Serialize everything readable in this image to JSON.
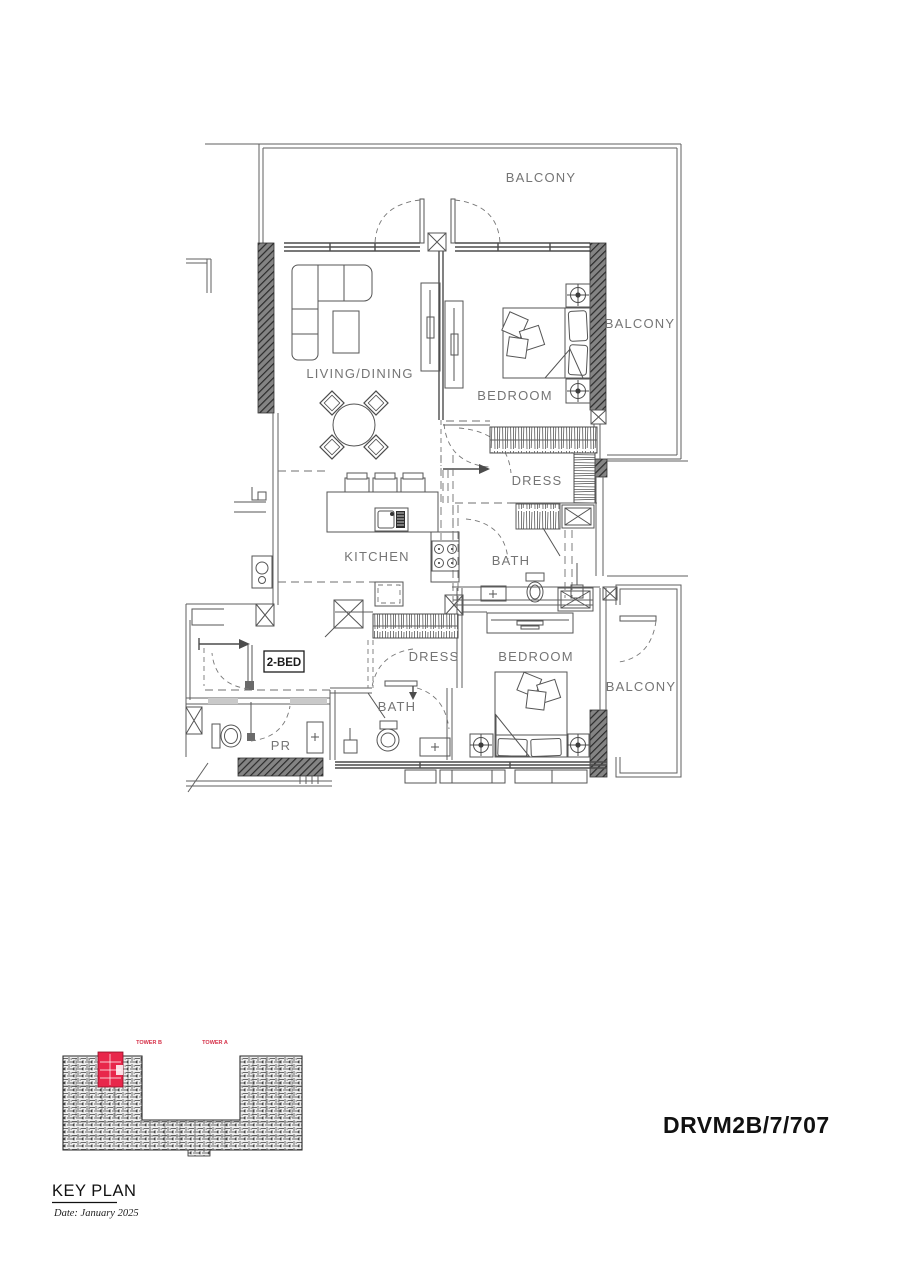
{
  "document": {
    "unit_code": "DRVM2B/7/707",
    "key_plan": {
      "title": "KEY PLAN",
      "date": "Date: January 2025",
      "tower_b": "TOWER B",
      "tower_a": "TOWER A",
      "highlight_color": "#e8274b",
      "tower_label_color": "#d63048"
    },
    "plan": {
      "unit_type": "2-BED",
      "labels": {
        "balcony_top": "BALCONY",
        "balcony_right": "BALCONY",
        "balcony_bottom": "BALCONY",
        "living_dining": "LIVING/DINING",
        "bedroom_top": "BEDROOM",
        "bedroom_bottom": "BEDROOM",
        "dress_top": "DRESS",
        "dress_bottom": "DRESS",
        "kitchen": "KITCHEN",
        "bath_top": "BATH",
        "bath_bottom": "BATH",
        "powder_room": "PR"
      }
    }
  }
}
